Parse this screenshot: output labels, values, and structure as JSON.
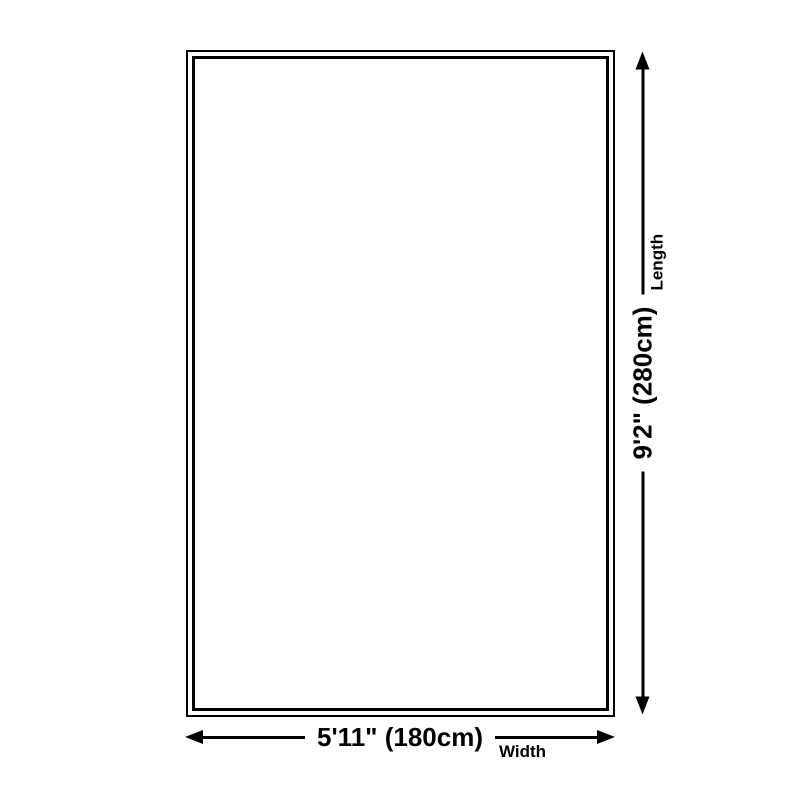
{
  "page": {
    "background": "#ffffff"
  },
  "diagram": {
    "line_color": "#000000",
    "rug": {
      "border_color": "#000000",
      "fill": "#ffffff"
    },
    "width_dim": {
      "value": "5'11\" (180cm)",
      "label": "Width"
    },
    "length_dim": {
      "value": "9'2\" (280cm)",
      "label": "Length"
    }
  }
}
